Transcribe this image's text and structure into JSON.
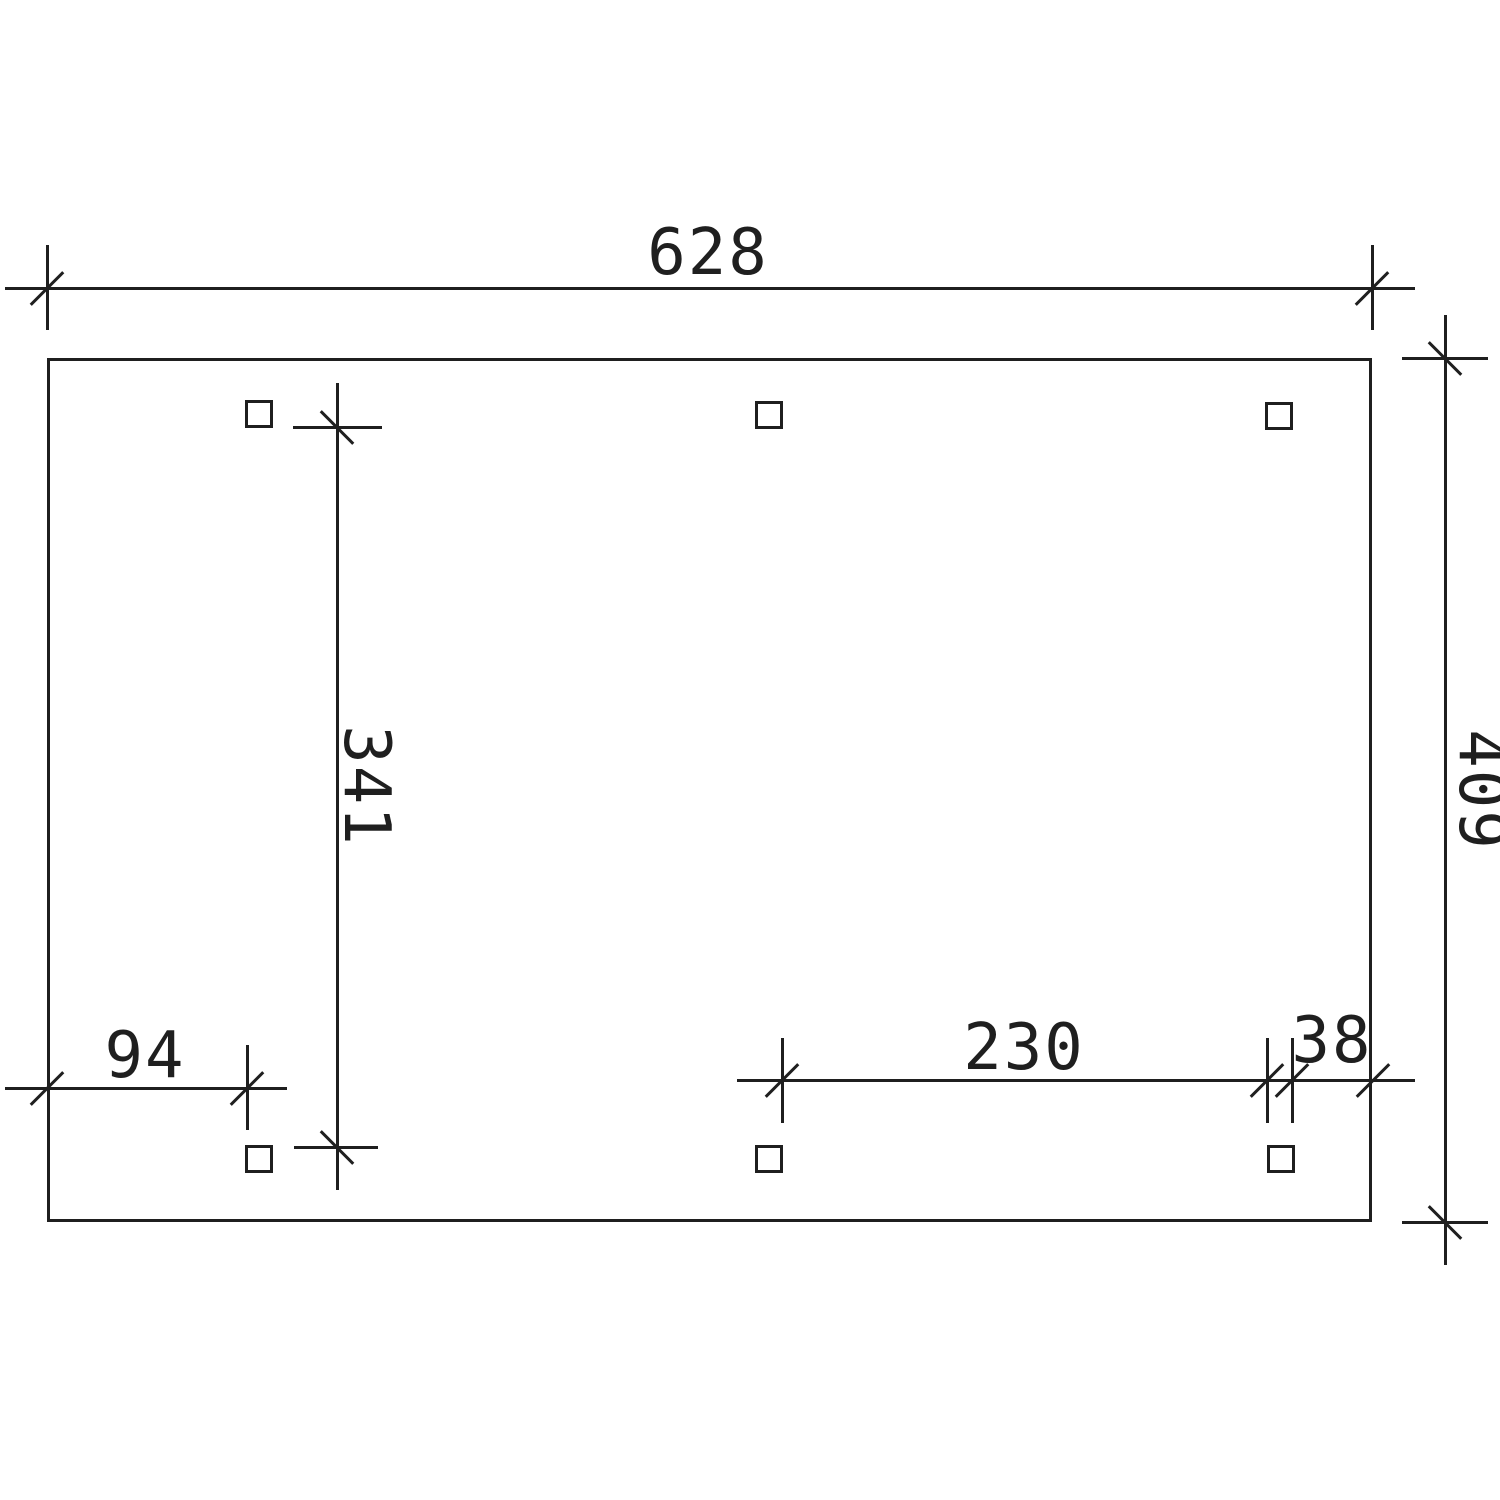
{
  "drawing": {
    "dimensions": {
      "width_total": {
        "label": "628"
      },
      "depth_total": {
        "label": "409"
      },
      "inner_depth": {
        "label": "341"
      },
      "left_offset": {
        "label": "94"
      },
      "post_span": {
        "label": "230"
      },
      "right_offset": {
        "label": "38"
      }
    },
    "colors": {
      "stroke": "#1f1f1f",
      "background": "#ffffff"
    },
    "geometry": {
      "stroke_width": 3,
      "tick_length": 46,
      "outline": {
        "x": 47,
        "y": 358,
        "w": 1325,
        "h": 864
      },
      "post_size": 28,
      "posts": [
        {
          "x": 245,
          "y": 400
        },
        {
          "x": 755,
          "y": 401
        },
        {
          "x": 1265,
          "y": 402
        },
        {
          "x": 245,
          "y": 1145
        },
        {
          "x": 755,
          "y": 1145
        },
        {
          "x": 1267,
          "y": 1145
        }
      ],
      "h_lines": [
        {
          "name": "dim-line-width-total",
          "x": 5,
          "y": 288,
          "len": 1410
        },
        {
          "name": "ext-line-depth-top",
          "x": 1402,
          "y": 358,
          "len": 86
        },
        {
          "name": "ext-line-depth-bottom",
          "x": 1402,
          "y": 1222,
          "len": 86
        },
        {
          "name": "ext-line-inner-top",
          "x": 293,
          "y": 427,
          "len": 89
        },
        {
          "name": "ext-line-inner-bottom",
          "x": 294,
          "y": 1147,
          "len": 84
        },
        {
          "name": "dim-line-left-offset",
          "x": 5,
          "y": 1088,
          "len": 282
        },
        {
          "name": "dim-line-post-span",
          "x": 737,
          "y": 1080,
          "len": 678
        }
      ],
      "v_lines": [
        {
          "name": "ext-line-width-left",
          "x": 47,
          "y": 245,
          "len": 85
        },
        {
          "name": "ext-line-width-right",
          "x": 1372,
          "y": 245,
          "len": 85
        },
        {
          "name": "dim-line-depth-total",
          "x": 1445,
          "y": 315,
          "len": 950
        },
        {
          "name": "dim-line-inner-depth",
          "x": 337,
          "y": 383,
          "len": 807
        },
        {
          "name": "ext-line-left-offset",
          "x": 247,
          "y": 1045,
          "len": 85
        },
        {
          "name": "ext-line-post-span-left",
          "x": 782,
          "y": 1038,
          "len": 85
        },
        {
          "name": "ext-line-post-left-edge",
          "x": 1267,
          "y": 1038,
          "len": 85
        },
        {
          "name": "ext-line-post-right-edge",
          "x": 1292,
          "y": 1038,
          "len": 85
        }
      ],
      "ticks": [
        {
          "x": 47,
          "y": 288,
          "dir": "fwd"
        },
        {
          "x": 1372,
          "y": 288,
          "dir": "fwd"
        },
        {
          "x": 1445,
          "y": 358,
          "dir": "back"
        },
        {
          "x": 1445,
          "y": 1222,
          "dir": "back"
        },
        {
          "x": 337,
          "y": 427,
          "dir": "back"
        },
        {
          "x": 337,
          "y": 1147,
          "dir": "back"
        },
        {
          "x": 47,
          "y": 1088,
          "dir": "fwd"
        },
        {
          "x": 247,
          "y": 1088,
          "dir": "fwd"
        },
        {
          "x": 782,
          "y": 1080,
          "dir": "fwd"
        },
        {
          "x": 1267,
          "y": 1080,
          "dir": "fwd"
        },
        {
          "x": 1292,
          "y": 1080,
          "dir": "fwd"
        },
        {
          "x": 1373,
          "y": 1080,
          "dir": "fwd"
        }
      ]
    }
  }
}
